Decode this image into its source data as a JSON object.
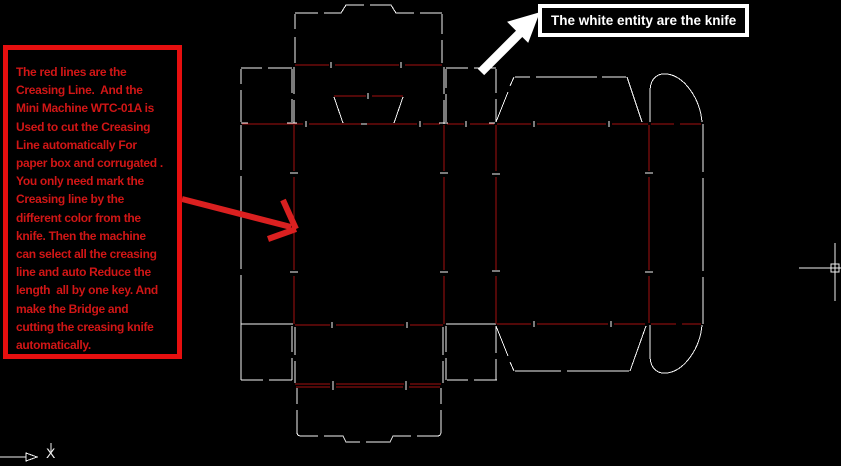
{
  "left_note": {
    "text": "The red lines are the\nCreasing Line.  And the\nMini Machine WTC-01A is\nUsed to cut the Creasing\nLine automatically For\npaper box and corrugated .\nYou only need mark the\nCreasing line by the\ndifferent color from the\nknife. Then the machine\ncan select all the creasing\nline and auto Reduce the\nlength  all by one key. And\nmake the Bridge and\ncutting the creasing knife\nautomatically.",
    "text_color": "#d11616",
    "border_color": "#e60f0f"
  },
  "right_note": {
    "text": "The white entity are the knife",
    "text_color": "#ffffff",
    "border_color": "#ffffff"
  },
  "ucs": {
    "x_label": "X"
  },
  "diagram": {
    "background": "#000000",
    "cut_color": "#f5f5f5",
    "crease_color": "#a31111",
    "cut_paths": [
      "M295,13 H318 M324,13 H341 L346,5 H364 M370,5 H391 L396,13 H414 M420,13 H442",
      "M295,14 V29 M295,37 V63",
      "M442,14 V34 M442,40 V63",
      "M241,68 H262 M268,68 H292",
      "M241,69 V84 M241,90 V122",
      "M292,69 V93 M292,99 V122",
      "M294,67 V94 M294,100 V124",
      "M444,67 V94 M444,100 V124",
      "M446,68 H468 M474,68 H496",
      "M446,69 V88 M446,94 V122",
      "M496,69 V93 M496,99 V122",
      "M334,97 L343,123 M403,97 L394,123 M344,124 H393",
      "M241,123 H248 M287,123 H297 M439,123 H448 M489,123 H495",
      "M241,125 V170 M241,176 V269 M241,275 V380",
      "M241,324 H293 M446,324 H496",
      "M292,326 V352 M292,358 V380",
      "M295,327 V355 M295,361 V383 M443,327 V355 M443,361 V383",
      "M446,326 V352 M446,358 V380",
      "M496,326 V353 M496,359 V380",
      "M241,380 H263 M269,380 H292 M447,380 H468 M474,380 H497",
      "M297,388 V404 M297,410 V432 Q297,436 301,436 H318 M324,436 H343 L346,442 H360 M366,442 H390 L393,436 H411 M417,436 H437 Q441,436 441,432 V410 M441,404 V388",
      "M496,122 L508,92 M510,86 L514,77",
      "M515,77 H530 M536,77 H597 M602,77 H626",
      "M627,77 L642,122",
      "M650,122 V92 C650,76 660,73 667,74 C684,76 700,98 702,122",
      "M703,124 V172 M703,178 V271 M703,277 V324",
      "M496,326 L508,356 M510,362 L514,371",
      "M515,371 H561 M567,371 H629",
      "M630,371 L646,326",
      "M650,325 V355 C650,371 660,374 667,373 C684,371 700,349 702,325"
    ],
    "crease_paths": [
      "M295,65 H329 M335,65 H399 M405,65 H442",
      "M334,96 H366 M372,96 H403",
      "M242,124 H303 M309,124 H361 M367,124 H417 M423,124 H440 M447,124 H464 M470,124 H494",
      "M294,125 V171 M294,177 V270 M294,276 V324",
      "M444,125 V171 M444,177 V270 M444,276 V324",
      "M496,125 V171 M496,177 V270 M496,276 V324",
      "M295,325 H330 M336,325 H404 M410,325 H443",
      "M295,384 H330 M336,384 H404 M410,384 H441",
      "M296,387 H330 M336,387 H403 M409,387 H440",
      "M497,124 H531 M537,124 H606 M612,124 H648 M651,124 H674 M680,124 H701",
      "M649,125 V171 M649,177 V270 M649,276 V323",
      "M497,324 H531 M537,324 H608 M614,324 H645 M651,324 H676 M682,324 H701"
    ],
    "bridge_ticks": [
      "M306,121 V127 M420,121 V127 M466,121 V127",
      "M331,62 V68 M401,62 V68 M368,93 V99",
      "M332,322 V328 M407,322 V328 M333,381 V390 M406,381 V390",
      "M534,121 V127 M609,121 V127 M534,321 V327 M611,321 V327",
      "M290,173 H298 M290,272 H298 M440,173 H448 M440,272 H448 M492,174 H500 M492,271 H500 M645,173 H653 M645,272 H653"
    ],
    "red_arrow": {
      "color": "#da2020",
      "width": 6,
      "paths": [
        "M182,199 L291,227",
        "M283,200 L296,229",
        "M268,239 L296,229"
      ]
    },
    "white_arrow": {
      "color": "#ffffff",
      "shaft": "M481,72 L520,33",
      "shaft_width": 9,
      "head": "M539,13 L508,22 L528,42 Z"
    },
    "crosshair": {
      "color": "#f0f0f0",
      "paths": [
        "M799,268 H841",
        "M835,243 V301"
      ],
      "pickbox": "M831,264 h8 v8 h-8 Z"
    },
    "ucs_icon": {
      "color": "#f0f0f0",
      "paths": [
        "M0,457 H26",
        "M51,443 V452"
      ],
      "arrowhead": "M26,453 L37,457 L26,461 Z"
    }
  }
}
